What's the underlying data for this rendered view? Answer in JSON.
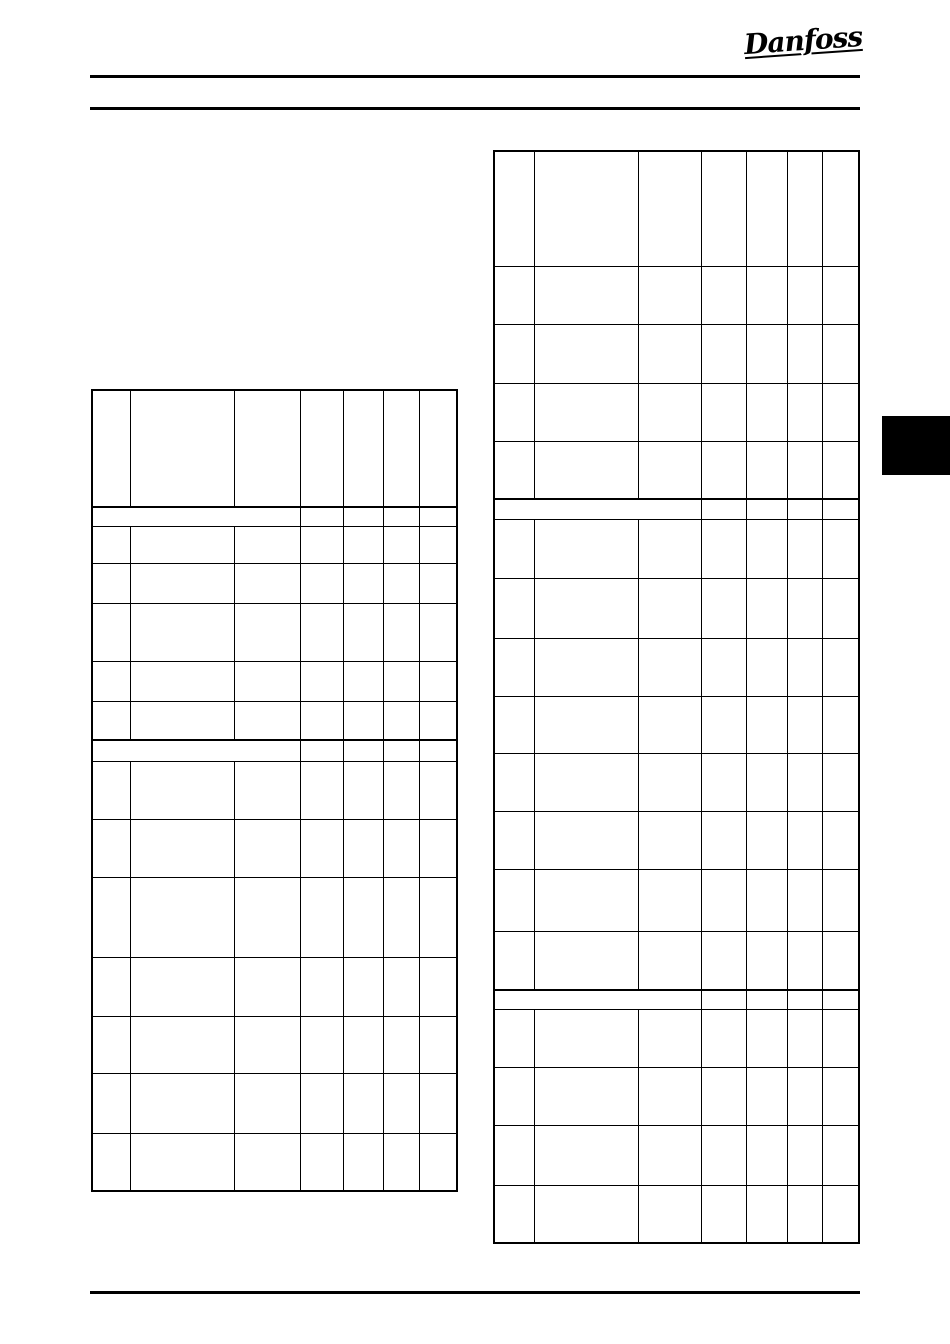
{
  "page": {
    "background_color": "#ffffff",
    "ink_color": "#000000"
  },
  "header": {
    "logo_text": "Danfoss"
  },
  "section_tab": {
    "color": "#000000"
  },
  "tables": [
    {
      "id": "left",
      "name": "parameter-table-left",
      "x": 91,
      "y": 389,
      "w": 367,
      "h": 803,
      "cols": [
        38,
        104,
        66,
        43,
        40,
        36,
        38
      ],
      "rows": [
        {
          "h": 116
        },
        {
          "h": 20,
          "band": true
        },
        {
          "h": 37
        },
        {
          "h": 40
        },
        {
          "h": 58
        },
        {
          "h": 40
        },
        {
          "h": 38
        },
        {
          "h": 22,
          "band": true
        },
        {
          "h": 58
        },
        {
          "h": 58
        },
        {
          "h": 80
        },
        {
          "h": 59
        },
        {
          "h": 57
        },
        {
          "h": 60
        },
        {
          "h": 58
        }
      ],
      "cells_text": []
    },
    {
      "id": "right",
      "name": "parameter-table-right",
      "x": 493,
      "y": 150,
      "w": 367,
      "h": 1094,
      "cols": [
        40,
        104,
        63,
        45,
        41,
        35,
        37
      ],
      "rows": [
        {
          "h": 115
        },
        {
          "h": 58
        },
        {
          "h": 59
        },
        {
          "h": 58
        },
        {
          "h": 57
        },
        {
          "h": 21,
          "band": true
        },
        {
          "h": 59
        },
        {
          "h": 60
        },
        {
          "h": 58
        },
        {
          "h": 57
        },
        {
          "h": 58
        },
        {
          "h": 58
        },
        {
          "h": 62
        },
        {
          "h": 58
        },
        {
          "h": 20,
          "band": true
        },
        {
          "h": 58
        },
        {
          "h": 58
        },
        {
          "h": 60
        },
        {
          "h": 58
        }
      ],
      "cells_text": []
    }
  ]
}
